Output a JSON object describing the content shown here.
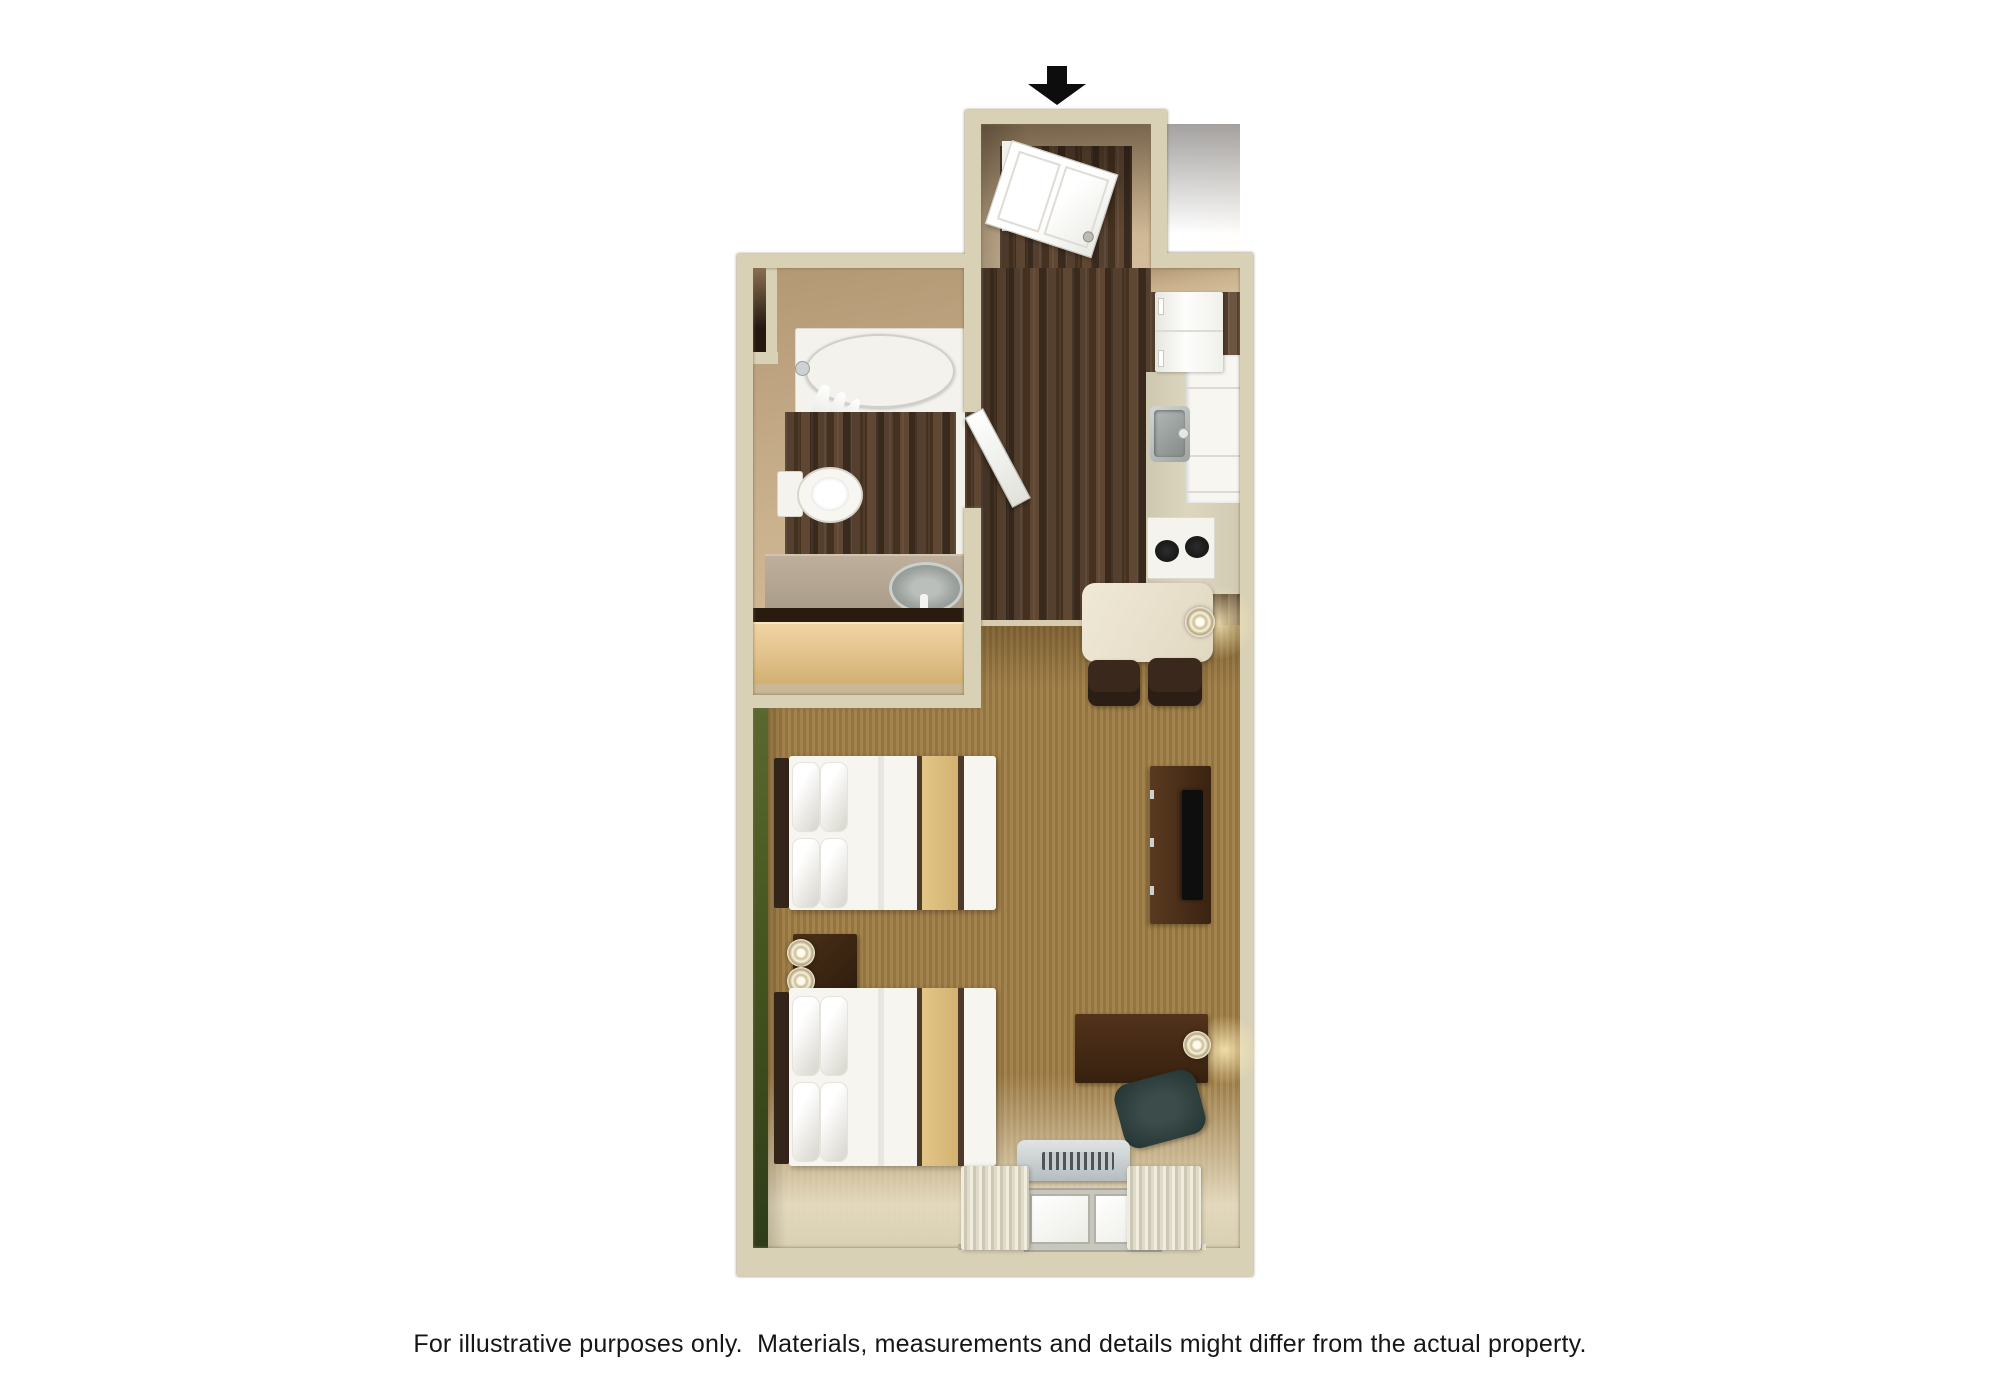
{
  "image_type": "3d-floor-plan-rendering",
  "entrance": {
    "arrow_icon": "down-arrow",
    "arrow_color": "#0d0d0d"
  },
  "disclaimer": {
    "text": "For illustrative purposes only.  Materials, measurements and details might differ from the actual property."
  },
  "palette": {
    "background": "#ffffff",
    "wall": "#d9d1b5",
    "wall_outline": "#7a6e4e",
    "inner_wall_tan": "#c7ad8a",
    "dark_wood_floor": "#4a3629",
    "carpet_brown": "#9c7d4a",
    "accent_wall_green": "#44531f",
    "fixture_white": "#f5f4ef",
    "counter_beige": "#d8d1ba",
    "dark_furniture_brown": "#3c2411",
    "light_wood_dresser": "#e2c28a",
    "bed_stripe_tan": "#d9ba7a",
    "office_chair_slate": "#2c3a38",
    "ac_unit_gray": "#c9ced0",
    "stainless_sink": "#9aa09c",
    "tv_black": "#0e0e0e"
  }
}
